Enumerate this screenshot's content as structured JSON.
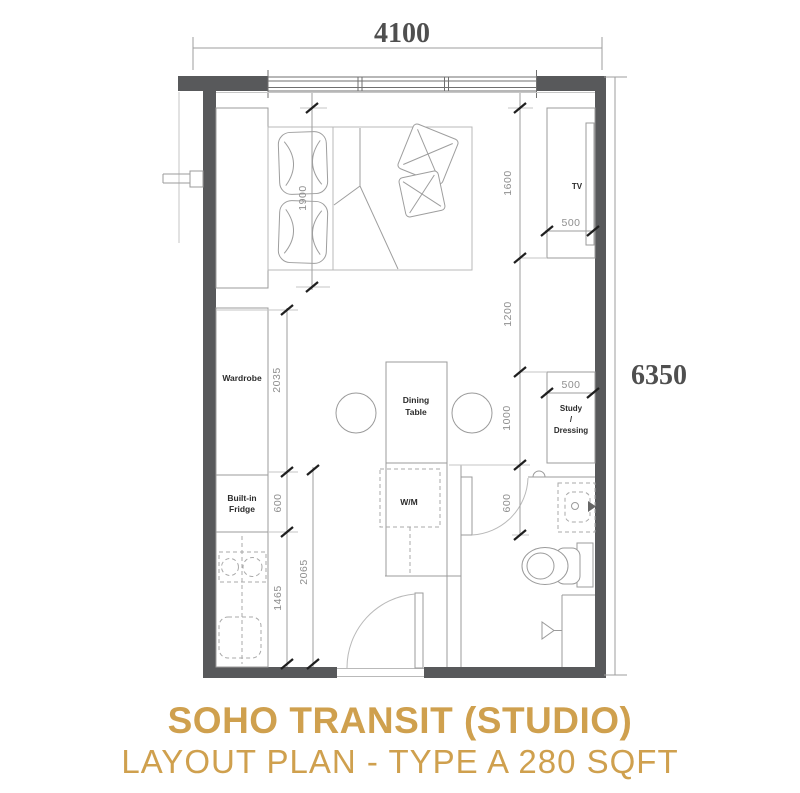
{
  "title": {
    "line1": "SOHO TRANSIT (STUDIO)",
    "line2": "LAYOUT PLAN - TYPE A 280 SQFT",
    "color": "#CFA04E"
  },
  "dimensions": {
    "overall_width": "4100",
    "overall_height": "6350",
    "bed_length": "1900",
    "tv_console_length": "1600",
    "tv_console_depth": "500",
    "tv_to_study_gap": "1200",
    "wardrobe_length": "2035",
    "study_length": "1000",
    "study_depth": "500",
    "fridge_width": "600",
    "bathroom_door": "600",
    "wm_kitchen_run": "2065",
    "kitchen_counter": "1465"
  },
  "labels": {
    "wardrobe": "Wardrobe",
    "fridge_line1": "Built-in",
    "fridge_line2": "Fridge",
    "dining_line1": "Dining",
    "dining_line2": "Table",
    "washing_machine": "W/M",
    "tv": "TV",
    "study_line1": "Study",
    "study_line2": "/",
    "study_line3": "Dressing"
  },
  "colors": {
    "wall": "#58595B",
    "furniture_line": "#9B9B9B",
    "dim_text": "#8F8F8F",
    "accent_gold": "#CF9F4C"
  }
}
